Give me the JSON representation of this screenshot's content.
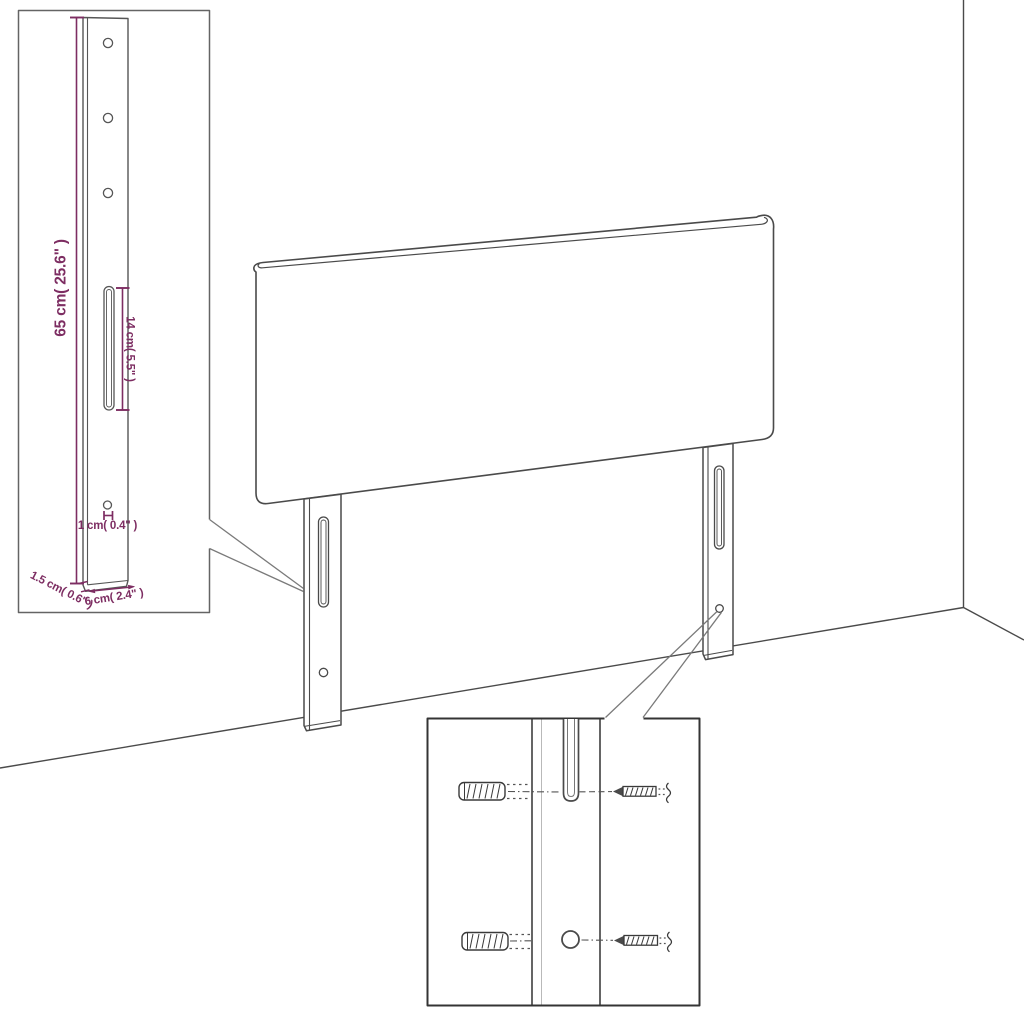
{
  "diagram": {
    "subject": "headboard with two slotted mounting legs shown in a room corner, with a magnified leg-dimension inset and a magnified wall-mounting inset",
    "background_color": "#ffffff",
    "line_color": "#4a4a4a",
    "dimension_text_color": "#7d2d62",
    "leader_line_color": "#7a7a7a",
    "leg_inset_border_color": "#646464",
    "mounting_inset_border_color": "#343434"
  },
  "dimensions": {
    "leg_height": "65 cm( 25.6\" )",
    "slot_length": "14 cm( 5.5\" )",
    "hole_diameter": "1 cm( 0.4\" )",
    "leg_thickness": "1.5 cm( 0.6\" )",
    "leg_width": "6 cm( 2.4\" )"
  },
  "mounting_detail": {
    "icons": [
      "wall-plug-icon",
      "screw-icon",
      "leg-slot",
      "leg-hole"
    ]
  }
}
